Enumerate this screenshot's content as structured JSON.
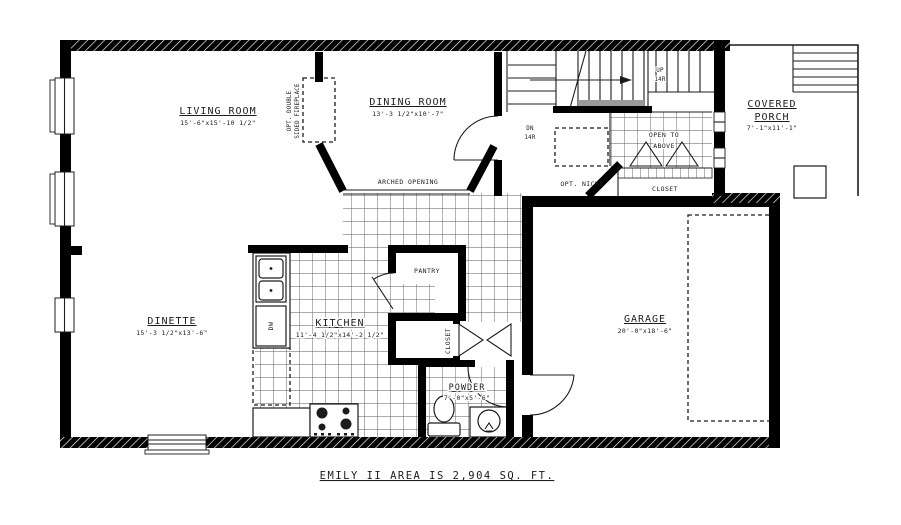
{
  "drawing": {
    "title": "EMILY II AREA IS 2,904 SQ. FT.",
    "rooms": {
      "living_room": {
        "name": "LIVING ROOM",
        "dims": "15'-6\"x15'-10 1/2\""
      },
      "dining_room": {
        "name": "DINING ROOM",
        "dims": "13'-3 1/2\"x10'-7\""
      },
      "covered_porch": {
        "line1": "COVERED",
        "line2": "PORCH",
        "dims": "7'-1\"x11'-1\""
      },
      "dinette": {
        "name": "DINETTE",
        "dims": "15'-3 1/2\"x13'-6\""
      },
      "kitchen": {
        "name": "KITCHEN",
        "dims": "11'-4 1/2\"x14'-2 1/2\""
      },
      "garage": {
        "name": "GARAGE",
        "dims": "20'-0\"x18'-6\""
      },
      "pantry": {
        "name": "PANTRY"
      },
      "powder_room": {
        "name": "POWDER",
        "dims": "7'-0\"x5'-6\""
      },
      "hall_closet": {
        "name": "CLOSET"
      },
      "foyer_closet": {
        "name": "CLOSET"
      }
    },
    "annotations": {
      "arched_opening": "ARCHED OPENING",
      "opt_niche": "OPT. NICHE",
      "open_to_above_line1": "OPEN TO",
      "open_to_above_line2": "ABOVE",
      "fireplace_line1": "OPT. DOUBLE",
      "fireplace_line2": "SIDED FIREPLACE",
      "stairs_up": "UP",
      "stairs_up_risers": "14R",
      "stairs_dn": "DN",
      "stairs_dn_risers": "14R",
      "dishwasher": "DW"
    },
    "colors": {
      "wall": "#000000",
      "paper": "#ffffff",
      "line": "#1c1c1c",
      "tile_line": "#5a5a5a",
      "stair_band": "#9a9a9a"
    }
  }
}
